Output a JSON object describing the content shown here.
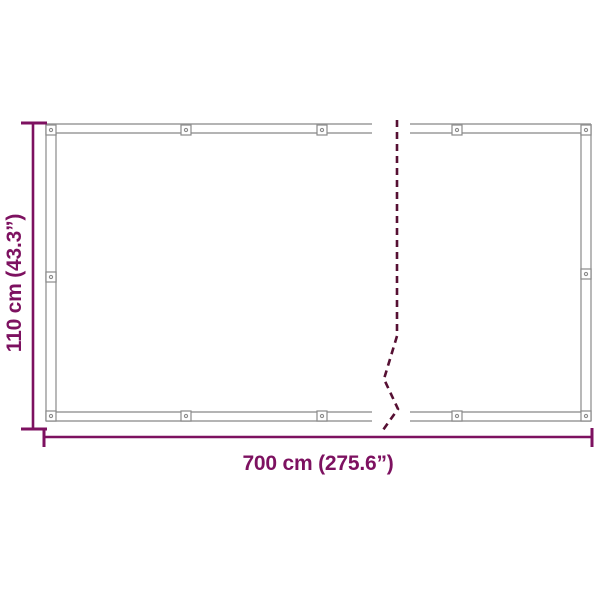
{
  "figure": {
    "kind": "product-dimension-diagram",
    "subject": "framed screen panel shown with a break mark indicating continued length",
    "dimensions": {
      "height": {
        "label": "110 cm (43.3”)",
        "cm": 110,
        "inches": 43.3
      },
      "width": {
        "label": "700 cm (275.6”)",
        "cm": 700,
        "inches": 275.6
      }
    },
    "icons": [
      {
        "name": "mounting-clip-icon",
        "description": "small square clip with center eyelet, repeated along frame edges"
      },
      {
        "name": "break-line-icon",
        "description": "dashed vertical zigzag break mark through the middle of the panel"
      }
    ],
    "colors": {
      "dimension_accent": "#7d1160",
      "frame_line": "#9b9b9b",
      "break_dash": "#561033",
      "background": "#ffffff"
    }
  }
}
